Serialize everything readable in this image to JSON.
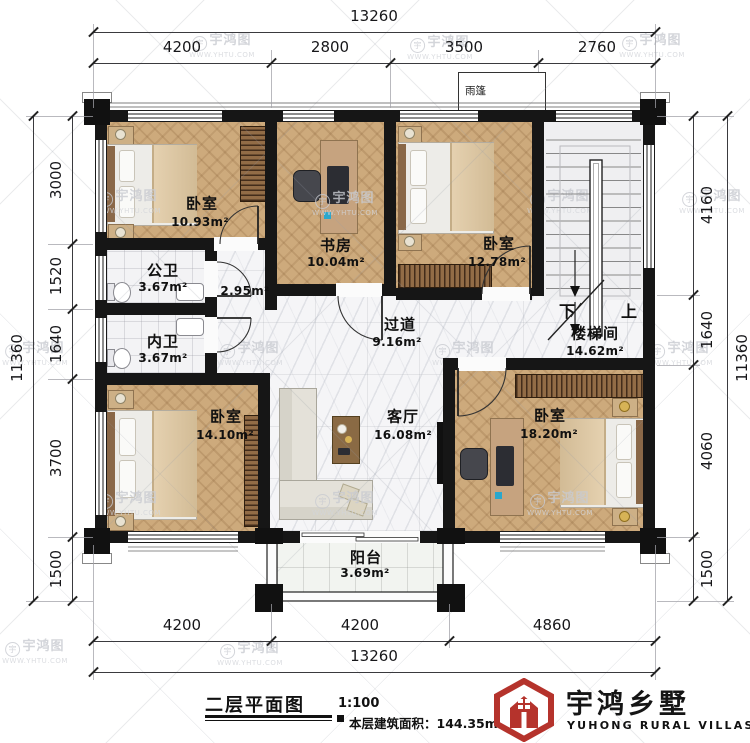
{
  "watermark": {
    "name": "宇鸿图",
    "url": "WWW.YHTU.COM",
    "symbol": "宇"
  },
  "plan": {
    "canopy": "雨篷",
    "stairs": {
      "down": "下",
      "up": "上"
    },
    "rooms": {
      "bed1": {
        "name": "卧室",
        "area": "10.93m²"
      },
      "study": {
        "name": "书房",
        "area": "10.04m²"
      },
      "bed2": {
        "name": "卧室",
        "area": "12.78m²"
      },
      "pub_bath": {
        "name": "公卫",
        "area": "3.67m²"
      },
      "pri_bath": {
        "name": "内卫",
        "area": "3.67m²"
      },
      "hallway": {
        "area": "2.95m²"
      },
      "corridor": {
        "name": "过道",
        "area": "9.16m²"
      },
      "stairwell": {
        "name": "楼梯间",
        "area": "14.62m²"
      },
      "bed3": {
        "name": "卧室",
        "area": "14.10m²"
      },
      "living": {
        "name": "客厅",
        "area": "16.08m²"
      },
      "bed4": {
        "name": "卧室",
        "area": "18.20m²"
      },
      "balcony": {
        "name": "阳台",
        "area": "3.69m²"
      }
    }
  },
  "dimensions": {
    "top_total": "13260",
    "top_segments": [
      "4200",
      "2800",
      "3500",
      "2760"
    ],
    "left_total": "11360",
    "left_segments": [
      "3000",
      "1520",
      "1640",
      "3700",
      "1500"
    ],
    "right_segments": [
      "4160",
      "1640",
      "4060",
      "1500"
    ],
    "right_total": "11360",
    "bottom_segments": [
      "4200",
      "4200",
      "4860"
    ],
    "bottom_total": "13260"
  },
  "titleblock": {
    "title": "二层平面图",
    "scale": "1:100",
    "area_label": "本层建筑面积：",
    "area_value": "144.35m²"
  },
  "brand": {
    "name": "宇鸿乡墅",
    "tagline": "YUHONG RURAL VILLAS",
    "red": "#b5332c"
  }
}
